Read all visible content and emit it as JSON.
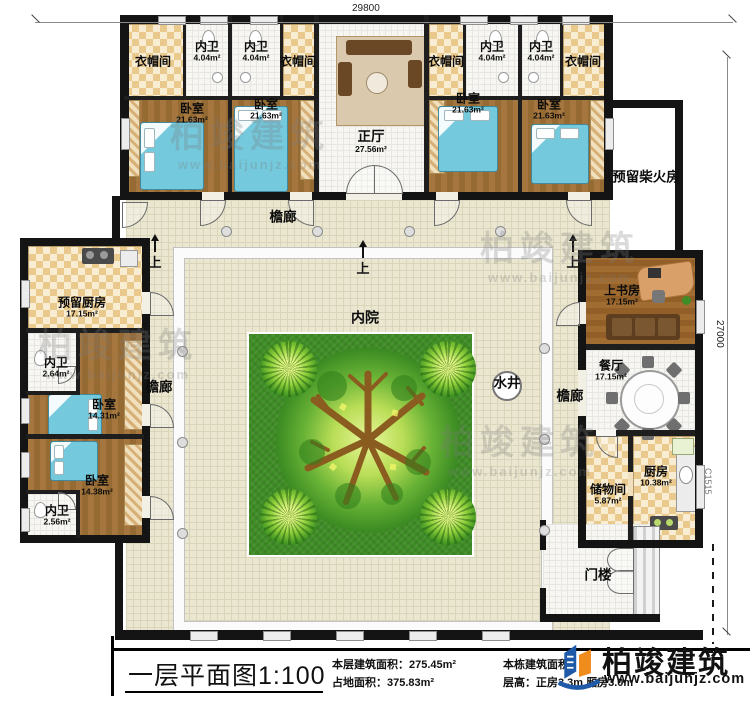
{
  "dims": {
    "top": "29800",
    "right": "27000",
    "window_tag": "C1515"
  },
  "rooms": {
    "yimaojian": {
      "name": "衣帽间"
    },
    "neiwei4": {
      "name": "内卫",
      "area": "4.04m²"
    },
    "woshi21": {
      "name": "卧室",
      "area": "21.63m²"
    },
    "zhengting": {
      "name": "正厅",
      "area": "27.56m²"
    },
    "chaihuofang": {
      "name": "预留柴火房"
    },
    "yuliuchufang": {
      "name": "预留厨房",
      "area": "17.15m²"
    },
    "neiwei264": {
      "name": "内卫",
      "area": "2.64m²"
    },
    "woshi1431": {
      "name": "卧室",
      "area": "14.31m²"
    },
    "woshi1438": {
      "name": "卧室",
      "area": "14.38m²"
    },
    "neiwei256": {
      "name": "内卫",
      "area": "2.56m²"
    },
    "shangshufang": {
      "name": "上书房",
      "area": "17.15m²"
    },
    "canting": {
      "name": "餐厅",
      "area": "17.15m²"
    },
    "chuwujian": {
      "name": "储物间",
      "area": "5.87m²"
    },
    "chufang": {
      "name": "厨房",
      "area": "10.38m²"
    },
    "menlou": {
      "name": "门楼"
    }
  },
  "courtyard": {
    "neiyuan": "内院",
    "shuijing": "水井",
    "yanlang": "檐廊",
    "shang": "上"
  },
  "titleblock": {
    "title": "一层平面图1:100",
    "stat1_label": "本层建筑面积：",
    "stat1_value": "275.45m²",
    "stat2_label": "占地面积：",
    "stat2_value": "375.83m²",
    "stat3_label": "本栋建筑面积：",
    "stat4_label": "层高：",
    "stat4_value": "正房3.3m 厢房3.0m"
  },
  "brand": {
    "name": "柏竣建筑",
    "url": "www.baijunjz.com"
  },
  "watermark": {
    "line1": "柏竣建筑",
    "line2": "www.baijunjz.com"
  }
}
